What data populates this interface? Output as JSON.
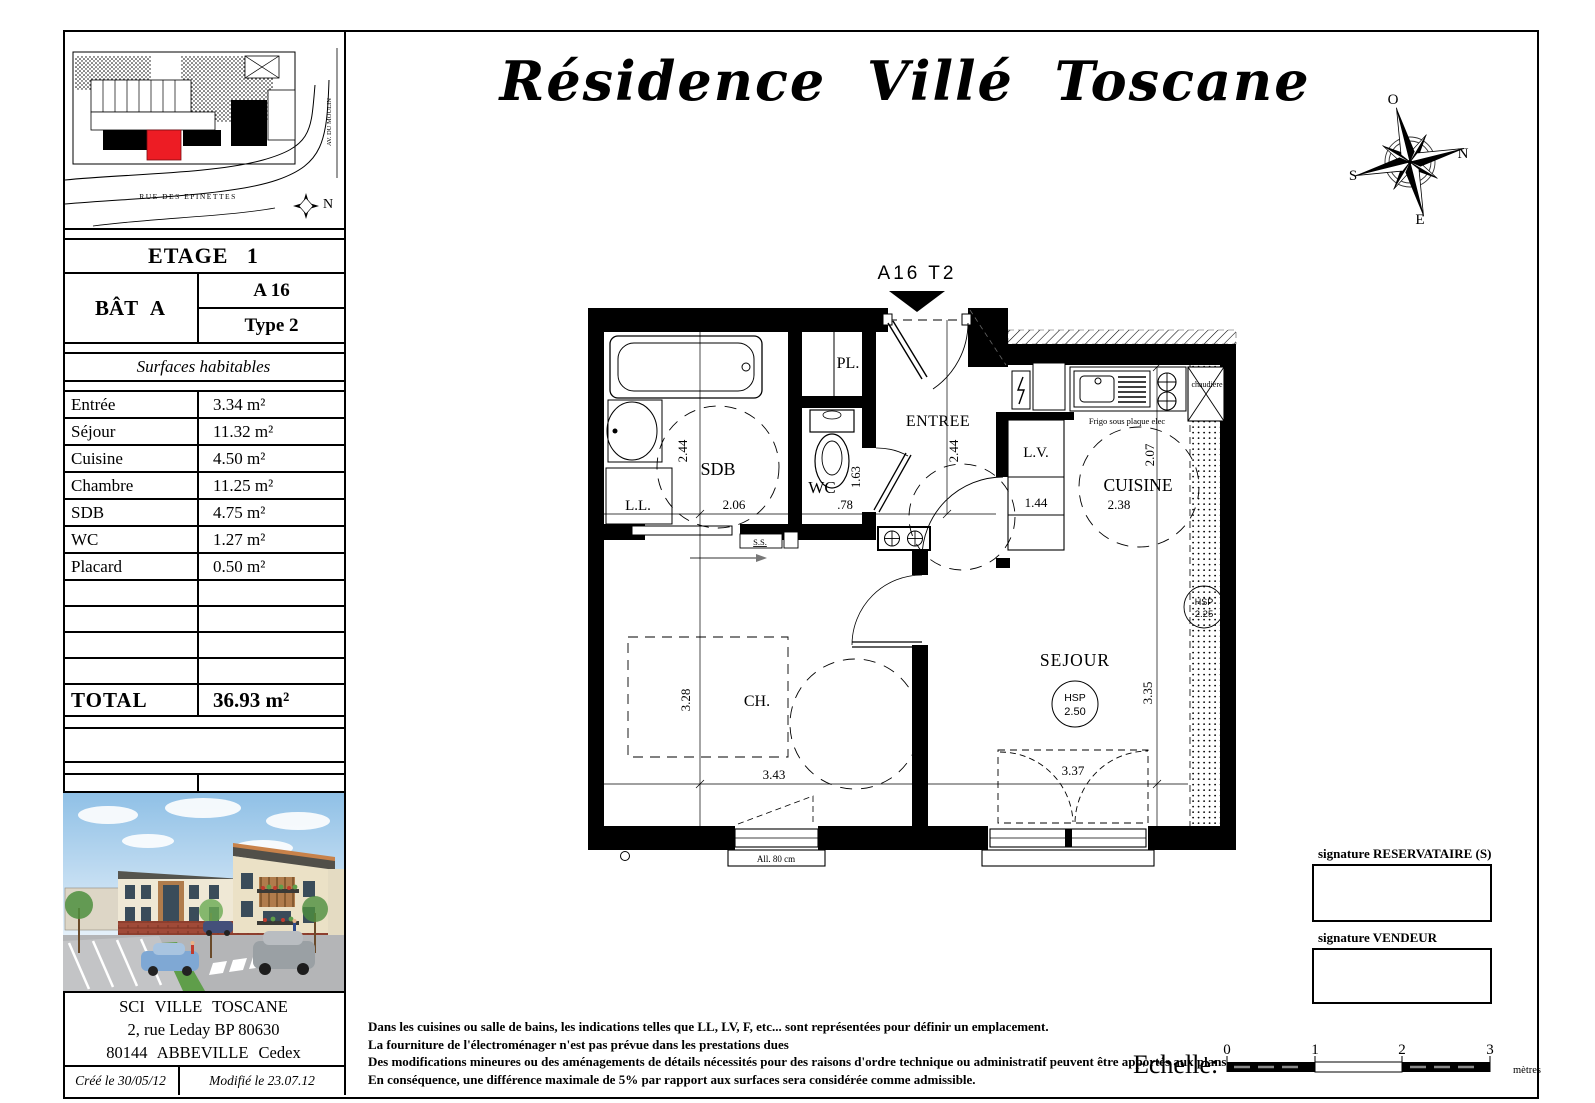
{
  "header": {
    "title": "Résidence Villé Toscane"
  },
  "compass": {
    "top": "O",
    "right": "N",
    "left": "S",
    "bottom": "E"
  },
  "site_plan": {
    "street": "RUE DES EPINETTES",
    "avenue": "AV. DU MOULIN",
    "north": "N"
  },
  "info": {
    "etage": "ETAGE 1",
    "batiment": "BÂT A",
    "lot": "A 16",
    "type": "Type 2",
    "surfaces_title": "Surfaces habitables",
    "rows": [
      {
        "label": "Entrée",
        "value": "3.34 m²"
      },
      {
        "label": "Séjour",
        "value": "11.32 m²"
      },
      {
        "label": "Cuisine",
        "value": "4.50 m²"
      },
      {
        "label": "Chambre",
        "value": "11.25 m²"
      },
      {
        "label": "SDB",
        "value": "4.75 m²"
      },
      {
        "label": "WC",
        "value": "1.27 m²"
      },
      {
        "label": "Placard",
        "value": "0.50 m²"
      }
    ],
    "total_label": "TOTAL",
    "total_value": "36.93 m²",
    "company_name": "SCI VILLE TOSCANE",
    "company_address1": "2, rue Leday BP 80630",
    "company_address2": "80144 ABBEVILLE Cedex",
    "created": "Créé le 30/05/12",
    "modified": "Modifié le  23.07.12"
  },
  "plan": {
    "unit_tag": "A16 T2",
    "rooms": {
      "sdb": "SDB",
      "wc": "WC",
      "placard": "PL.",
      "entree": "ENTREE",
      "lave_vaisselle": "L.V.",
      "lave_linge": "L.L.",
      "cuisine": "CUISINE",
      "chambre": "CH.",
      "sejour": "SEJOUR"
    },
    "dims": {
      "sdb_w": "2.06",
      "sdb_h": "2.44",
      "wc_w": ".78",
      "wc_h": "1.63",
      "entree_w": "1.44",
      "entree_h": "2.44",
      "cuisine_w": "2.38",
      "cuisine_h": "2.07",
      "ch_w": "3.43",
      "ch_h": "3.28",
      "sejour_w": "3.37",
      "sejour_h": "3.35"
    },
    "notes": {
      "frigo": "Frigo sous plaque elec",
      "chaudiere": "chaudière",
      "seche_serviettes": "S.S.",
      "allege": "All. 80 cm",
      "hsp_label": "HSP",
      "hsp_sejour": "2.50",
      "hsp_loggia": "2.25"
    }
  },
  "signatures": {
    "reservataire": "signature RESERVATAIRE (S)",
    "vendeur": "signature VENDEUR"
  },
  "disclaimer": [
    "Dans les cuisines ou salle de bains, les indications telles que LL, LV, F, etc... sont représentées pour définir un emplacement.",
    "La fourniture de l'électroménager n'est pas prévue dans les prestations dues",
    "Des modifications mineures ou des aménagements de détails nécessités pour des raisons d'ordre technique ou administratif peuvent être apportés aux plans.",
    "En conséquence, une différence maximale de 5% par rapport aux surfaces sera considérée comme admissible."
  ],
  "scale": {
    "label": "Echelle:",
    "t0": "0",
    "t1": "1",
    "t2": "2",
    "t3": "3",
    "unit": "mètres"
  }
}
